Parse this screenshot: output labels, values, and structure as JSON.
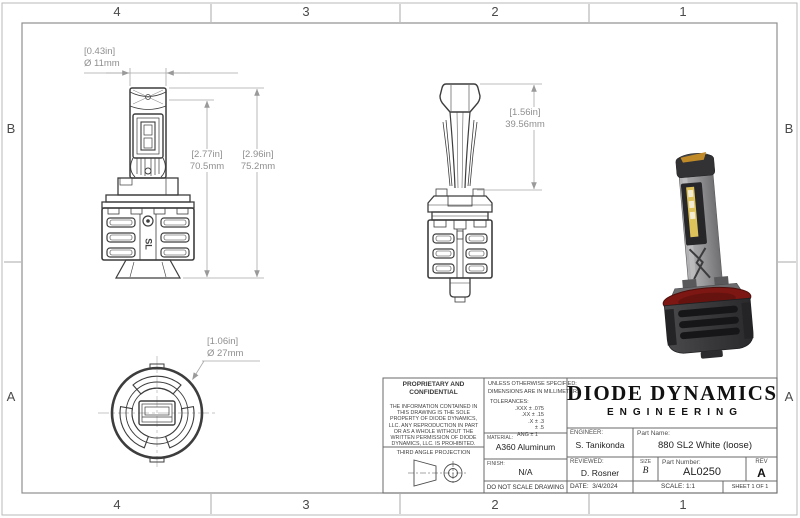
{
  "sheet": {
    "zones_top": [
      "4",
      "3",
      "2",
      "1"
    ],
    "zones_bottom": [
      "4",
      "3",
      "2",
      "1"
    ],
    "zones_left": [
      "B",
      "A"
    ],
    "zones_right": [
      "B",
      "A"
    ]
  },
  "dimensions": {
    "emitter_width": {
      "in": "[0.43in]",
      "mm": "Ø 11mm"
    },
    "body_height": {
      "in": "[2.77in]",
      "mm": "70.5mm"
    },
    "overall_height": {
      "in": "[2.96in]",
      "mm": "75.2mm"
    },
    "upper_height": {
      "in": "[1.56in]",
      "mm": "39.56mm"
    },
    "base_diameter": {
      "in": "[1.06in]",
      "mm": "Ø 27mm"
    }
  },
  "views": {
    "heatsink_logo": "SL"
  },
  "title_block": {
    "proprietary_title": "PROPRIETARY AND CONFIDENTIAL",
    "proprietary_body": "THE INFORMATION CONTAINED IN THIS DRAWING IS THE SOLE PROPERTY OF DIODE DYNAMICS, LLC.  ANY REPRODUCTION IN PART OR AS A WHOLE WITHOUT THE WRITTEN PERMISSION OF DIODE DYNAMICS, LLC. IS PROHIBITED.",
    "projection_label": "THIRD ANGLE PROJECTION",
    "units_note_1": "UNLESS OTHERWISE SPECIFIED:",
    "units_note_2": "DIMENSIONS ARE IN MILLIMETERS",
    "tolerances_label": "TOLERANCES:",
    "tolerances": [
      ".XXX ± .075",
      ".XX ± .15",
      ".X ± .3",
      "± .5",
      "ANG ± 1"
    ],
    "material_label": "MATERIAL:",
    "material": "A360 Aluminum",
    "finish_label": "FINISH:",
    "finish": "N/A",
    "no_scale": "DO NOT SCALE DRAWING",
    "company_line1": "DIODE DYNAMICS",
    "company_line2": "ENGINEERING",
    "engineer_label": "ENGINEER:",
    "engineer": "S. Tanikonda",
    "reviewed_label": "REVIEWED:",
    "reviewed": "D. Rosner",
    "date_label": "DATE:",
    "date": "3/4/2024",
    "part_name_label": "Part Name:",
    "part_name": "880 SL2 White (loose)",
    "size_label": "SIZE",
    "size": "B",
    "part_number_label": "Part Number:",
    "part_number": "AL0250",
    "rev_label": "REV",
    "rev": "A",
    "scale": "SCALE: 1:1",
    "sheet": "SHEET 1 OF 1"
  }
}
